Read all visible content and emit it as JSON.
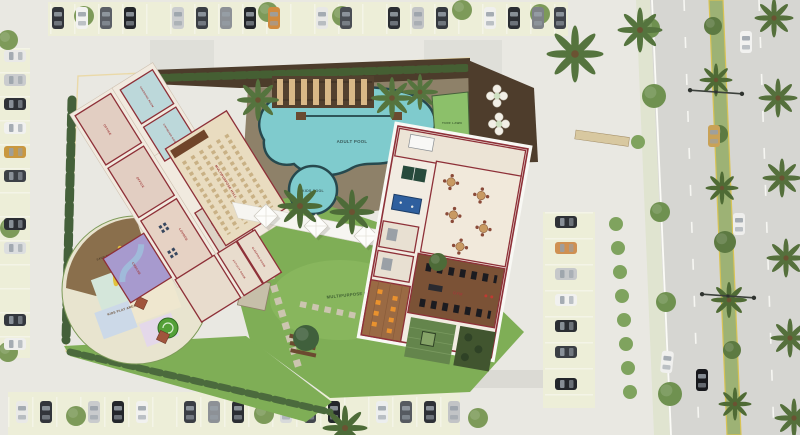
{
  "labels": {
    "adult_pool": "ADULT POOL",
    "kids_pool": "KIDS POOL",
    "multipurpose_lawn": "MULTIPURPOSE LAWN",
    "turf_lawn": "TURF LAWN",
    "kids_play_area": "KIDS PLAY AREA",
    "sand_pit": "SAND PIT",
    "creche": "CRECHE",
    "sleeping_room": "SLEEPING ROOM",
    "activity_room": "ACTIVITY ROOM",
    "office_1": "OFFICE",
    "office_2": "OFFICE",
    "lounge": "LOUNGE",
    "lift_lobby": "LIFT LOBBY",
    "changing_room_1": "CHANGING ROOM",
    "changing_room_2": "CHANGING ROOM",
    "multipurpose_hall": "MULTIPURPOSE HALL",
    "gym": "GYM"
  },
  "colors": {
    "lawn": "#7fae56",
    "pool_water": "#7fcbcd",
    "pool_edge": "#27494e",
    "deck": "#8e8169",
    "soil": "#4c3c2b",
    "wall_red": "#8e3038",
    "floor": "#f1eadf",
    "creche_purple": "#a79ace",
    "changing_blue": "#bcd8da",
    "gym_wood": "#7b5236",
    "yoga_wood": "#9a6a44",
    "mat_orange": "#ea922e",
    "billiard_blue": "#2f5f9e",
    "tt_green": "#274a3c",
    "road": "#d6d6d2",
    "median_green": "#9db275",
    "parking_strip": "#edeed8",
    "paving": "#e9e8e2",
    "canopy_white": "#f6f5f1",
    "hedge": "#455f33"
  },
  "icons": {
    "car": "top-view-vehicle",
    "palm_tree": "palm-frond-star",
    "tree": "round-canopy",
    "shrub": "small-round-bush",
    "street_light": "double-arm-lamp",
    "cafe_table": "round-table-with-4-chairs",
    "planter_cluster": "five-circle-planters",
    "canopy": "tensile-sail-diamond",
    "stepping_stones": "paver-dashes",
    "billiard_table": "blue-pool-table",
    "table_tennis": "green-tt-table",
    "gym_equipment": "black-machines",
    "slide": "yellow-slide",
    "lift": "elevator-cars"
  }
}
